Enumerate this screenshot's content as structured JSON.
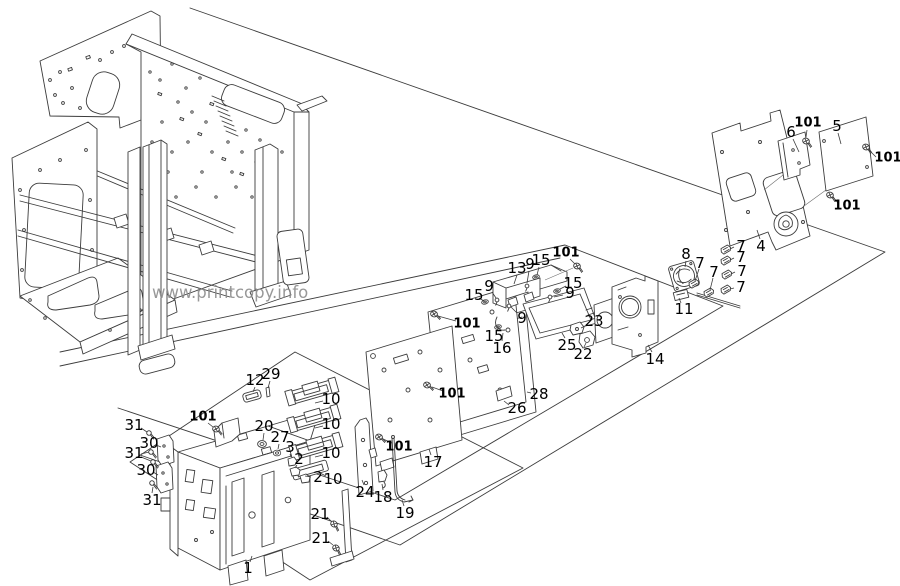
{
  "page": {
    "background": "#ffffff"
  },
  "watermark": {
    "text": "www.printcopy.info",
    "x": 152,
    "y": 298,
    "color": "#8a8a8a",
    "font_size": 16.5
  },
  "diagram": {
    "description": "Exploded parts diagram: electrical box, PCB shields, rear panels and fan bracket of a copier frame",
    "stroke": "#3c3c3c",
    "label_color": "#000000",
    "callouts": [
      {
        "text": "6",
        "x": 791,
        "y": 132,
        "leaders": [
          [
            793,
            139,
            799,
            152
          ]
        ]
      },
      {
        "text": "101",
        "x": 808,
        "y": 123,
        "bold": true,
        "leaders": [
          [
            807,
            130,
            806,
            137
          ]
        ]
      },
      {
        "text": "5",
        "x": 837,
        "y": 126,
        "leaders": [
          [
            838,
            133,
            841,
            144
          ]
        ]
      },
      {
        "text": "101",
        "x": 888,
        "y": 158,
        "bold": true,
        "leaders": [
          [
            876,
            157,
            869,
            150
          ]
        ]
      },
      {
        "text": "101",
        "x": 847,
        "y": 206,
        "bold": true,
        "leaders": [
          [
            838,
            203,
            833,
            197
          ]
        ]
      },
      {
        "text": "4",
        "x": 761,
        "y": 246,
        "leaders": [
          [
            760,
            239,
            757,
            230
          ]
        ]
      },
      {
        "text": "7",
        "x": 741,
        "y": 246,
        "leaders": [
          [
            734,
            247,
            730,
            249
          ]
        ]
      },
      {
        "text": "7",
        "x": 741,
        "y": 257,
        "leaders": [
          [
            734,
            258,
            730,
            260
          ]
        ]
      },
      {
        "text": "7",
        "x": 742,
        "y": 271,
        "leaders": [
          [
            735,
            272,
            731,
            274
          ]
        ]
      },
      {
        "text": "7",
        "x": 741,
        "y": 287,
        "leaders": [
          [
            734,
            288,
            730,
            289
          ]
        ]
      },
      {
        "text": "8",
        "x": 686,
        "y": 254,
        "leaders": [
          [
            686,
            261,
            685,
            267
          ]
        ]
      },
      {
        "text": "7",
        "x": 700,
        "y": 263,
        "leaders": [
          [
            699,
            269,
            695,
            281
          ]
        ]
      },
      {
        "text": "7",
        "x": 714,
        "y": 272,
        "leaders": [
          [
            713,
            278,
            710,
            290
          ]
        ]
      },
      {
        "text": "11",
        "x": 684,
        "y": 309,
        "leaders": [
          [
            681,
            303,
            679,
            298
          ]
        ]
      },
      {
        "text": "14",
        "x": 655,
        "y": 359,
        "leaders": [
          [
            652,
            352,
            648,
            345
          ]
        ]
      },
      {
        "text": "13",
        "x": 517,
        "y": 268,
        "leaders": [
          [
            517,
            275,
            514,
            284
          ]
        ]
      },
      {
        "text": "9",
        "x": 530,
        "y": 264,
        "leaders": [
          [
            529,
            271,
            527,
            283
          ]
        ]
      },
      {
        "text": "15",
        "x": 541,
        "y": 260,
        "leaders": [
          [
            539,
            267,
            537,
            275
          ]
        ]
      },
      {
        "text": "101",
        "x": 566,
        "y": 253,
        "bold": true,
        "leaders": [
          [
            570,
            259,
            575,
            264
          ]
        ]
      },
      {
        "text": "15",
        "x": 573,
        "y": 283,
        "leaders": [
          [
            566,
            286,
            560,
            289
          ]
        ]
      },
      {
        "text": "9",
        "x": 570,
        "y": 293,
        "leaders": [
          [
            563,
            295,
            554,
            297
          ]
        ]
      },
      {
        "text": "9",
        "x": 489,
        "y": 286,
        "leaders": [
          [
            492,
            292,
            496,
            298
          ]
        ]
      },
      {
        "text": "15",
        "x": 474,
        "y": 295,
        "leaders": [
          [
            479,
            298,
            484,
            301
          ]
        ]
      },
      {
        "text": "101",
        "x": 467,
        "y": 324,
        "bold": true,
        "leaders": [
          [
            456,
            321,
            438,
            316
          ]
        ]
      },
      {
        "text": "9",
        "x": 522,
        "y": 318,
        "leaders": [
          [
            517,
            313,
            511,
            307
          ]
        ]
      },
      {
        "text": "15",
        "x": 494,
        "y": 336,
        "leaders": [
          [
            497,
            330,
            499,
            328
          ]
        ]
      },
      {
        "text": "16",
        "x": 502,
        "y": 348,
        "leaders": [
          [
            502,
            341,
            503,
            333
          ]
        ]
      },
      {
        "text": "23",
        "x": 594,
        "y": 321,
        "leaders": [
          [
            587,
            325,
            581,
            328
          ]
        ]
      },
      {
        "text": "25",
        "x": 567,
        "y": 345,
        "leaders": [
          [
            565,
            338,
            562,
            333
          ]
        ]
      },
      {
        "text": "22",
        "x": 583,
        "y": 354,
        "leaders": [
          [
            584,
            347,
            586,
            343
          ]
        ]
      },
      {
        "text": "101",
        "x": 452,
        "y": 394,
        "bold": true,
        "leaders": [
          [
            443,
            391,
            432,
            387
          ]
        ]
      },
      {
        "text": "28",
        "x": 539,
        "y": 394,
        "leaders": [
          [
            531,
            393,
            527,
            392
          ]
        ]
      },
      {
        "text": "26",
        "x": 517,
        "y": 408,
        "leaders": [
          [
            509,
            405,
            504,
            401
          ]
        ]
      },
      {
        "text": "101",
        "x": 399,
        "y": 447,
        "bold": true,
        "leaders": [
          [
            392,
            443,
            383,
            439
          ]
        ]
      },
      {
        "text": "17",
        "x": 433,
        "y": 462,
        "leaders": [
          [
            431,
            455,
            429,
            449
          ]
        ]
      },
      {
        "text": "24",
        "x": 365,
        "y": 492,
        "leaders": [
          [
            364,
            485,
            362,
            480
          ]
        ]
      },
      {
        "text": "18",
        "x": 383,
        "y": 497,
        "leaders": [
          [
            383,
            490,
            382,
            484
          ]
        ]
      },
      {
        "text": "19",
        "x": 405,
        "y": 513,
        "leaders": [
          [
            404,
            506,
            402,
            500
          ]
        ]
      },
      {
        "text": "12",
        "x": 255,
        "y": 380,
        "leaders": [
          [
            255,
            387,
            253,
            392
          ]
        ]
      },
      {
        "text": "29",
        "x": 271,
        "y": 374,
        "leaders": [
          [
            270,
            381,
            268,
            388
          ]
        ]
      },
      {
        "text": "10",
        "x": 331,
        "y": 399,
        "leaders": [
          [
            323,
            401,
            315,
            403
          ]
        ]
      },
      {
        "text": "101",
        "x": 203,
        "y": 417,
        "bold": true,
        "leaders": [
          [
            208,
            423,
            213,
            427
          ]
        ]
      },
      {
        "text": "31",
        "x": 134,
        "y": 425,
        "leaders": [
          [
            141,
            428,
            147,
            432
          ]
        ]
      },
      {
        "text": "20",
        "x": 264,
        "y": 426,
        "leaders": [
          [
            264,
            433,
            263,
            440
          ]
        ]
      },
      {
        "text": "10",
        "x": 331,
        "y": 424,
        "leaders": [
          [
            323,
            426,
            315,
            428
          ]
        ]
      },
      {
        "text": "27",
        "x": 280,
        "y": 437,
        "leaders": [
          [
            279,
            444,
            278,
            449
          ]
        ]
      },
      {
        "text": "30",
        "x": 149,
        "y": 443,
        "leaders": [
          [
            156,
            445,
            161,
            447
          ]
        ]
      },
      {
        "text": "31",
        "x": 134,
        "y": 453,
        "leaders": [
          [
            141,
            454,
            149,
            452
          ],
          [
            141,
            457,
            151,
            461
          ]
        ]
      },
      {
        "text": "3",
        "x": 290,
        "y": 447,
        "leaders": [
          [
            290,
            454,
            291,
            457
          ]
        ]
      },
      {
        "text": "2",
        "x": 299,
        "y": 459,
        "leaders": [
          [
            297,
            465,
            295,
            468
          ]
        ]
      },
      {
        "text": "10",
        "x": 331,
        "y": 453,
        "leaders": [
          [
            323,
            455,
            315,
            457
          ]
        ]
      },
      {
        "text": "30",
        "x": 146,
        "y": 470,
        "leaders": [
          [
            153,
            472,
            158,
            475
          ]
        ]
      },
      {
        "text": "2",
        "x": 318,
        "y": 477,
        "leaders": [
          [
            311,
            477,
            305,
            476
          ]
        ]
      },
      {
        "text": "10",
        "x": 333,
        "y": 479,
        "leaders": [
          [
            326,
            476,
            320,
            473
          ]
        ]
      },
      {
        "text": "31",
        "x": 152,
        "y": 500,
        "leaders": [
          [
            152,
            493,
            153,
            487
          ]
        ]
      },
      {
        "text": "21",
        "x": 320,
        "y": 514,
        "leaders": [
          [
            327,
            517,
            331,
            521
          ]
        ]
      },
      {
        "text": "21",
        "x": 321,
        "y": 538,
        "leaders": [
          [
            328,
            541,
            333,
            545
          ]
        ]
      },
      {
        "text": "1",
        "x": 248,
        "y": 568,
        "leaders": [
          [
            250,
            562,
            252,
            556
          ]
        ]
      }
    ]
  }
}
